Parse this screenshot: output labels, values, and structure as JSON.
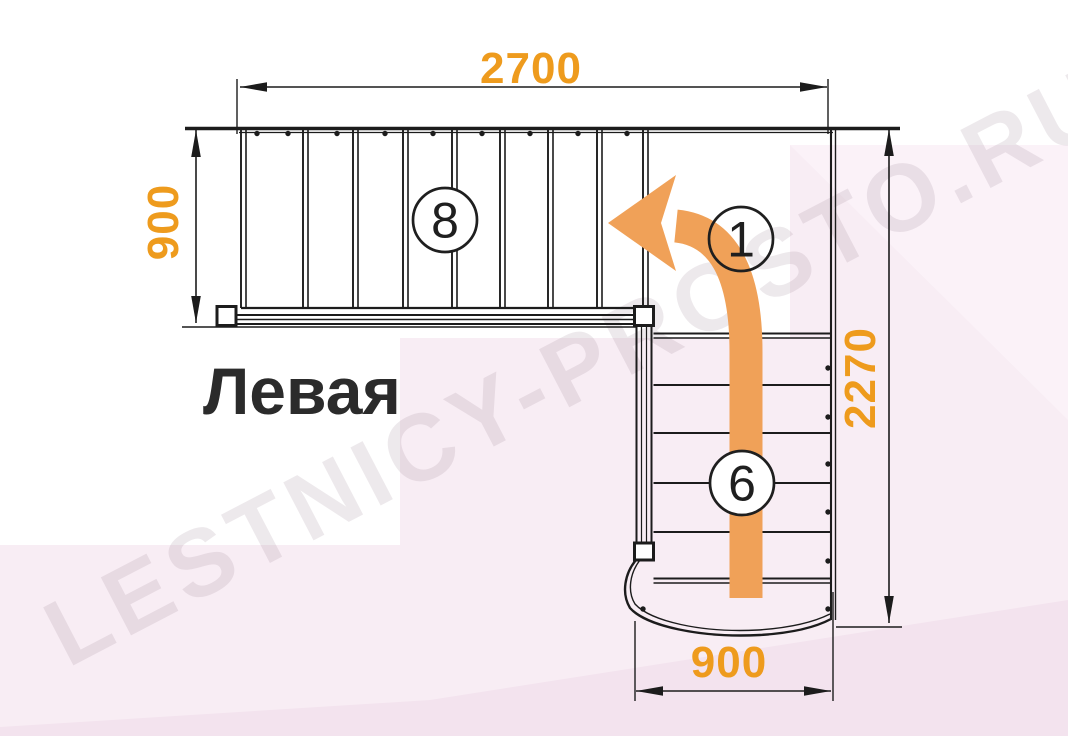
{
  "title_label": "Левая",
  "watermark_text": "LESTNICY-PROSTO.RU",
  "dimensions": {
    "top": "2700",
    "left": "900",
    "right": "2270",
    "bottom": "900"
  },
  "callouts": [
    {
      "label": "8",
      "x": 445,
      "y": 220,
      "r": 32,
      "fill": "#ffffff"
    },
    {
      "label": "1",
      "x": 741,
      "y": 239,
      "r": 32,
      "fill": "none"
    },
    {
      "label": "6",
      "x": 742,
      "y": 483,
      "r": 32,
      "fill": "#ffffff"
    }
  ],
  "colors": {
    "line": "#1c1c1c",
    "dimension_text": "#ee9b1d",
    "arrow_orange": "#f0a158",
    "title_text": "#2b2b2b",
    "pink_main": "#f8edf4",
    "pink_dark": "#f3e3ee"
  },
  "structure": {
    "canvas": [
      1068,
      736
    ],
    "top_edge": {
      "main": [
        185,
        128.5,
        900,
        128.5
      ],
      "inner": [
        239,
        132.5,
        833,
        132.5
      ]
    },
    "top_flight": {
      "riser_x": [
        241,
        303,
        353,
        403,
        452,
        500,
        548,
        597,
        643
      ],
      "riser_pair_offset": 5,
      "y1": 130,
      "y2": 308,
      "dots_y": 133.5,
      "dots_x": [
        257,
        288,
        337,
        385,
        433,
        482,
        530,
        578,
        627
      ]
    },
    "landing_right_edge": {
      "x": [
        831,
        835.5
      ],
      "y1": 130,
      "y2": 620
    },
    "tread_bottom_edge": [
      241,
      308,
      648,
      308
    ],
    "stringer": {
      "x1": 235,
      "x2": 637,
      "lines_y": [
        315,
        319.5,
        324
      ]
    },
    "left_ext_line": [
      182,
      327,
      637,
      327
    ],
    "rail": {
      "x": [
        636.5,
        641.5,
        646.5,
        651.5
      ],
      "y1": 325.5,
      "y2": 543
    },
    "newel_posts": [
      [
        217,
        306.5,
        19,
        19
      ],
      [
        634.5,
        306.5,
        19,
        19
      ],
      [
        634.5,
        543,
        19,
        17
      ]
    ],
    "lower_flight": {
      "x1": 653.5,
      "x2": 831,
      "tread_y": [
        335,
        385,
        433,
        483,
        532,
        580
      ],
      "double_y": [
        335,
        580
      ],
      "dots_x": 828,
      "dots_y": [
        368,
        417,
        464,
        512,
        561,
        609
      ],
      "extra_dot": [
        643,
        609
      ]
    },
    "curve_outer": "M 636 560 C 625 573 621 593 630 608 C 646 626 700 638 760 635 C 792 633 816 627 831 619",
    "curve_inner": "M 640 560 C 630 573 627 591 635 604 C 650 621 701 633 758 630 C 788 628 812 623 830 614",
    "dims": {
      "top": {
        "line": [
          240,
          87,
          827,
          87
        ],
        "ext": [
          [
            237,
            79,
            237,
            134
          ],
          [
            828,
            79,
            828,
            134
          ]
        ]
      },
      "left": {
        "line": [
          196,
          130,
          196,
          323
        ],
        "ext": []
      },
      "right": {
        "line": [
          889,
          129,
          889,
          623
        ],
        "ext": [
          [
            836,
            627,
            902,
            627
          ]
        ]
      },
      "bottom": {
        "line": [
          636,
          691,
          831,
          691
        ],
        "ext": [
          [
            635,
            621,
            635,
            701
          ],
          [
            833,
            592,
            833,
            701
          ]
        ]
      }
    },
    "arrow_path": "M 746 598 L 746 352 Q 746 233 676 226",
    "arrow_head_points": "608,223 676,175 661,223 676,271",
    "arrow_width": 33
  }
}
